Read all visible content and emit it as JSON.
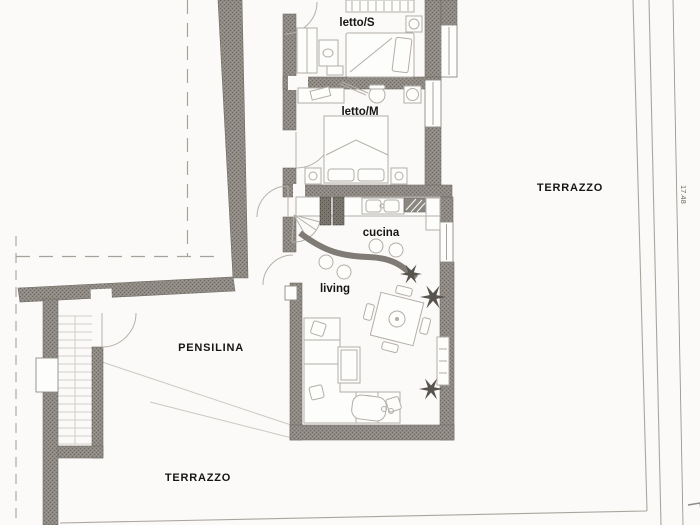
{
  "document": {
    "type": "architectural-floor-plan"
  },
  "rooms": [
    {
      "id": "letto-s",
      "label": "letto/S"
    },
    {
      "id": "letto-m",
      "label": "letto/M"
    },
    {
      "id": "cucina",
      "label": "cucina"
    },
    {
      "id": "living",
      "label": "living"
    }
  ],
  "areas": [
    {
      "id": "pensilina",
      "label": "PENSILINA"
    },
    {
      "id": "terrazzo-right",
      "label": "TERRAZZO"
    },
    {
      "id": "terrazzo-bottom",
      "label": "TERRAZZO"
    }
  ],
  "dimensions": [
    {
      "id": "terrace-length",
      "value": "17.48"
    }
  ],
  "colors": {
    "wall": "#8f8b84",
    "wall_dark": "#7b776f",
    "furniture_line": "#b3aea7",
    "thin_line": "#a8a49f",
    "label": "#161616",
    "background": "#fbfaf8"
  }
}
